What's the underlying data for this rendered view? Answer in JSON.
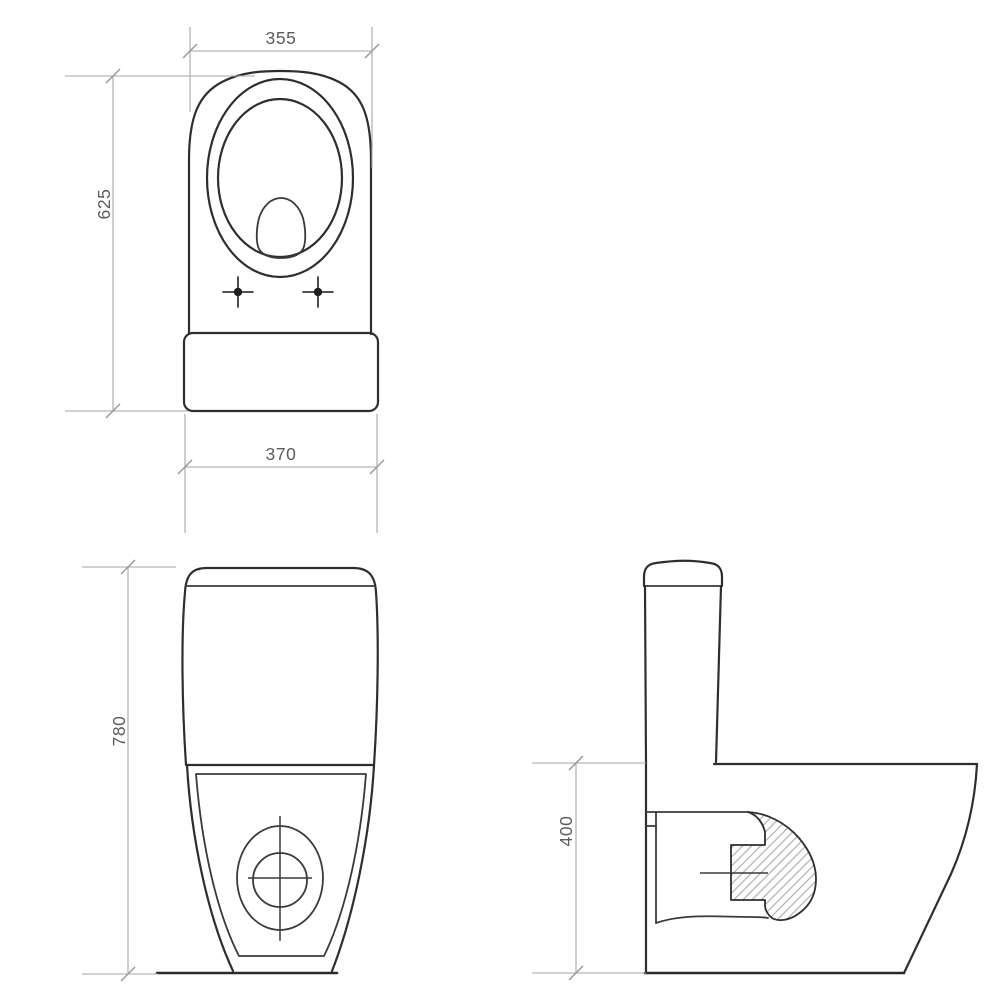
{
  "drawing": {
    "kind": "technical-dimension-drawing",
    "views": {
      "top": {
        "dims": {
          "seat_width": "355",
          "overall_depth": "625",
          "cistern_width": "370"
        }
      },
      "front": {
        "dims": {
          "overall_height": "780"
        }
      },
      "side": {
        "dims": {
          "bowl_height": "400"
        }
      }
    },
    "colors": {
      "background": "#ffffff",
      "outline": "#2e2e2e",
      "dimension_line": "#a6a6a6",
      "dimension_text": "#5c5c5c",
      "hatch": "#a9a9a9"
    }
  }
}
